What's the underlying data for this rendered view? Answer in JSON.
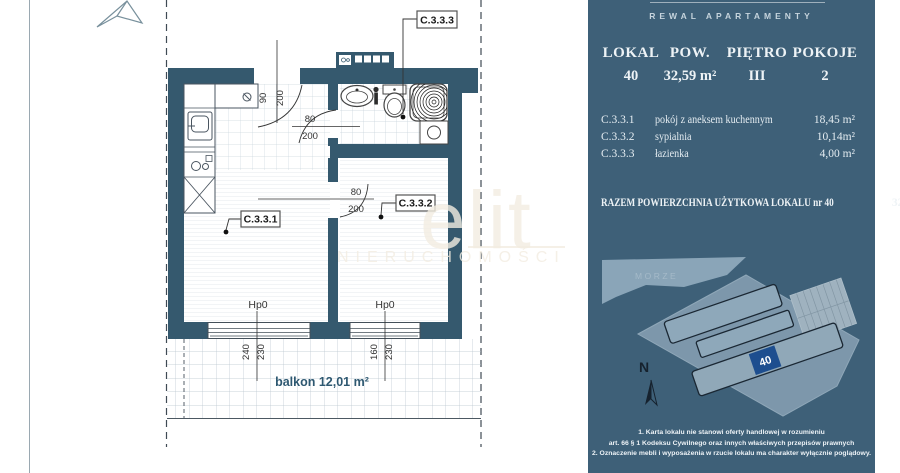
{
  "brand": "REWAL APARTAMENTY",
  "summary": {
    "headers": [
      "LOKAL",
      "POW.",
      "PIĘTRO",
      "POKOJE"
    ],
    "values": [
      "40",
      "32,59 m²",
      "III",
      "2"
    ]
  },
  "rooms": [
    {
      "code": "C.3.3.1",
      "name": "pokój z aneksem kuchennym",
      "area": "18,45 m²"
    },
    {
      "code": "C.3.3.2",
      "name": "sypialnia",
      "area": "10,14m²"
    },
    {
      "code": "C.3.3.3",
      "name": "łazienka",
      "area": "4,00 m²"
    }
  ],
  "total": {
    "label": "RAZEM POWIERZCHNIA UŻYTKOWA LOKALU nr 40",
    "value": "32,59m²"
  },
  "floor_plan": {
    "labels": {
      "living": "C.3.3.1",
      "bedroom": "C.3.3.2",
      "bathroom": "C.3.3.3"
    },
    "balcony": "balkon 12,01 m²",
    "hp_left": "Hp0",
    "hp_right": "Hp0",
    "dims": {
      "entrance": [
        "90",
        "200"
      ],
      "bathroom_door": [
        "80",
        "200"
      ],
      "bedroom_door": [
        "80",
        "200"
      ],
      "window_left": [
        "240",
        "230"
      ],
      "window_right": [
        "160",
        "230"
      ]
    }
  },
  "site_map": {
    "sea_label": "MORZE",
    "unit_marker": "40",
    "north_label": "N"
  },
  "watermark": {
    "line1": "elit",
    "line2": "NIERUCHOMOŚCI"
  },
  "disclaimer": [
    "1. Karta lokalu nie stanowi oferty handlowej w rozumieniu",
    "art. 66 § 1 Kodeksu Cywilnego oraz innych właściwych przepisów prawnych",
    "2. Oznaczenie mebli i wyposażenia w rzucie lokalu ma charakter wyłącznie poglądowy."
  ],
  "colors": {
    "panel_bg": "#3e6078",
    "wall": "#35596e",
    "marker_blue": "#1d4e8f",
    "accent_text": "#2e5871"
  }
}
